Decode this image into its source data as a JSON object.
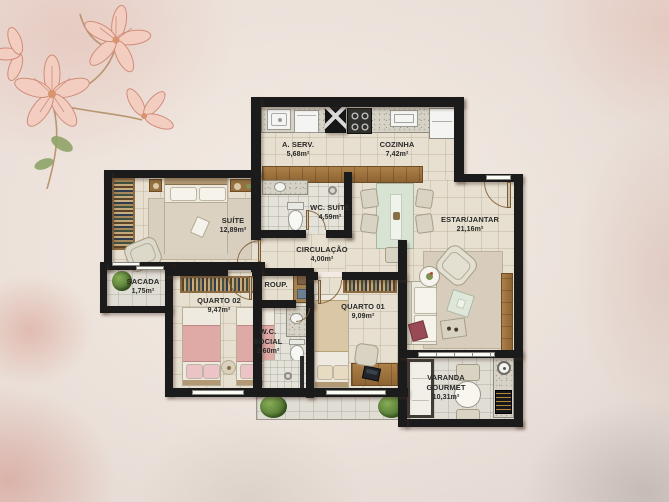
{
  "plan": {
    "rooms": {
      "aserv": {
        "name": "A. SERV.",
        "area": "5,68m²"
      },
      "cozinha": {
        "name": "COZINHA",
        "area": "7,42m²"
      },
      "suite": {
        "name": "SUÍTE",
        "area": "12,89m²"
      },
      "wc_suite": {
        "name": "WC. SUÍTE",
        "area": "4,59m²"
      },
      "circulacao": {
        "name": "CIRCULAÇÃO",
        "area": "4,00m²"
      },
      "estar_jantar": {
        "name": "ESTAR/JANTAR",
        "area": "21,16m²"
      },
      "sacada": {
        "name": "SACADA",
        "area": "1,75m²"
      },
      "quarto02": {
        "name": "QUARTO 02",
        "area": "9,47m²"
      },
      "roup": {
        "name": "ROUP."
      },
      "wc_social": {
        "name": "W.C. SOCIAL",
        "area": "3,60m²"
      },
      "quarto01": {
        "name": "QUARTO 01",
        "area": "9,09m²"
      },
      "varanda": {
        "name": "VARANDA GOURMET",
        "area": "10,31m²"
      }
    },
    "colors": {
      "wall": "#1b1b1b",
      "floor": "#e7e0d0",
      "tile": "#e4e2d9",
      "outdoor": "#e0ddd4",
      "wood": "#a0763f",
      "label": "#2a2a2a",
      "accent_pink": "#dfa9a6",
      "plant": "#5c8438"
    }
  }
}
